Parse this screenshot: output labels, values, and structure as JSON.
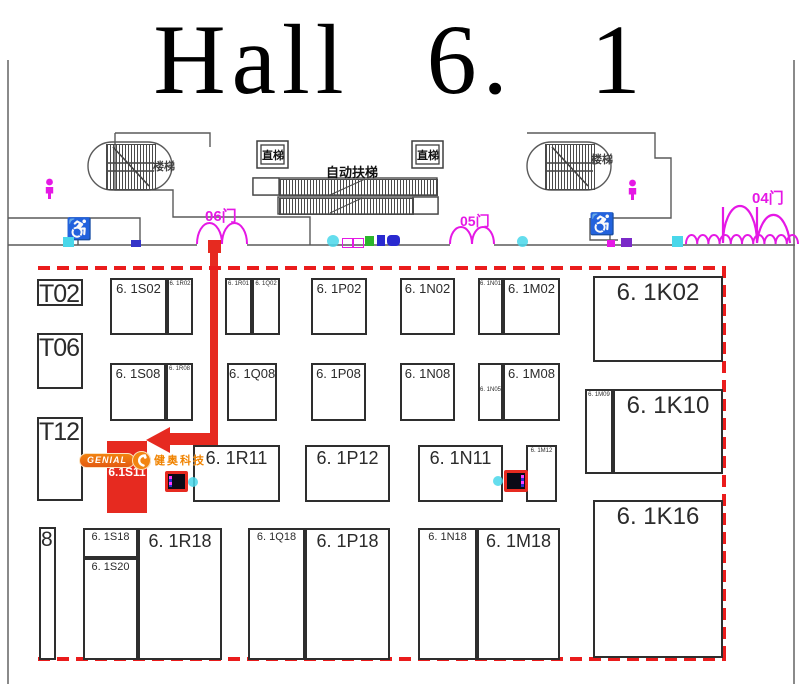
{
  "title": "Hall 6. 1",
  "facilities": {
    "stairs_left": "楼梯",
    "stairs_right": "楼梯",
    "elevator_left": "直梯",
    "elevator_right": "直梯",
    "escalator": "自动扶梯",
    "door_06": "06门",
    "door_05": "05门",
    "door_04": "04门"
  },
  "highlight": {
    "booth_label": "6.1S11",
    "logo_text": "GENIAL",
    "company_name": "健奥科技"
  },
  "colors": {
    "booth_outline": "#2e2e2e",
    "magenta": "#e518e5",
    "boundary_red": "#ea1c1c",
    "arrow_red": "#e62a20",
    "logo_orange": "#f08300",
    "cyan": "#49d7ea"
  },
  "booths": [
    {
      "label": "T02",
      "x": 37,
      "y": 279,
      "w": 46,
      "h": 27,
      "fs": 25,
      "cls": "flush"
    },
    {
      "label": "T06",
      "x": 37,
      "y": 333,
      "w": 46,
      "h": 56,
      "fs": 25,
      "cls": "flush"
    },
    {
      "label": "T12",
      "x": 37,
      "y": 417,
      "w": 46,
      "h": 84,
      "fs": 25,
      "cls": "flush"
    },
    {
      "label": "8",
      "x": 39,
      "y": 527,
      "w": 17,
      "h": 133,
      "fs": 21,
      "cls": "flush"
    },
    {
      "label": "6. 1S02",
      "x": 110,
      "y": 278,
      "w": 57,
      "h": 57,
      "fs": 13
    },
    {
      "label": "6. 1R02",
      "x": 167,
      "y": 278,
      "w": 26,
      "h": 57,
      "fs": 6
    },
    {
      "label": "6. 1R01",
      "x": 225,
      "y": 278,
      "w": 27,
      "h": 57,
      "fs": 6
    },
    {
      "label": "6. 1Q02",
      "x": 252,
      "y": 278,
      "w": 28,
      "h": 57,
      "fs": 6
    },
    {
      "label": "6. 1P02",
      "x": 311,
      "y": 278,
      "w": 56,
      "h": 57,
      "fs": 13
    },
    {
      "label": "6. 1N02",
      "x": 400,
      "y": 278,
      "w": 55,
      "h": 57,
      "fs": 13
    },
    {
      "label": "6. 1N01",
      "x": 478,
      "y": 278,
      "w": 25,
      "h": 57,
      "fs": 6
    },
    {
      "label": "6. 1M02",
      "x": 503,
      "y": 278,
      "w": 57,
      "h": 57,
      "fs": 13
    },
    {
      "label": "6. 1K02",
      "x": 593,
      "y": 276,
      "w": 130,
      "h": 86,
      "fs": 24
    },
    {
      "label": "6. 1S08",
      "x": 110,
      "y": 363,
      "w": 56,
      "h": 58,
      "fs": 13
    },
    {
      "label": "6. 1R08",
      "x": 166,
      "y": 363,
      "w": 27,
      "h": 58,
      "fs": 6
    },
    {
      "label": "6. 1Q08",
      "x": 227,
      "y": 363,
      "w": 50,
      "h": 58,
      "fs": 13
    },
    {
      "label": "6. 1P08",
      "x": 311,
      "y": 363,
      "w": 55,
      "h": 58,
      "fs": 13
    },
    {
      "label": "6. 1N08",
      "x": 400,
      "y": 363,
      "w": 55,
      "h": 58,
      "fs": 13
    },
    {
      "label": "6. 1N05",
      "x": 478,
      "y": 363,
      "w": 25,
      "h": 58,
      "fs": 6,
      "dy": 22
    },
    {
      "label": "6. 1M08",
      "x": 503,
      "y": 363,
      "w": 57,
      "h": 58,
      "fs": 13
    },
    {
      "label": "6. 1M09",
      "x": 585,
      "y": 389,
      "w": 28,
      "h": 85,
      "fs": 6
    },
    {
      "label": "6. 1K10",
      "x": 613,
      "y": 389,
      "w": 110,
      "h": 85,
      "fs": 24
    },
    {
      "label": "6. 1R11",
      "x": 193,
      "y": 445,
      "w": 87,
      "h": 57,
      "fs": 18
    },
    {
      "label": "6. 1P12",
      "x": 305,
      "y": 445,
      "w": 85,
      "h": 57,
      "fs": 18
    },
    {
      "label": "6. 1N11",
      "x": 418,
      "y": 445,
      "w": 85,
      "h": 57,
      "fs": 18
    },
    {
      "label": "6. 1M12",
      "x": 526,
      "y": 445,
      "w": 31,
      "h": 57,
      "fs": 6
    },
    {
      "label": "6. 1K16",
      "x": 593,
      "y": 500,
      "w": 130,
      "h": 158,
      "fs": 24
    },
    {
      "label": "6. 1S18",
      "x": 83,
      "y": 528,
      "w": 55,
      "h": 30,
      "fs": 11
    },
    {
      "label": "6. 1S20",
      "x": 83,
      "y": 558,
      "w": 55,
      "h": 102,
      "fs": 11
    },
    {
      "label": "6. 1R18",
      "x": 138,
      "y": 528,
      "w": 84,
      "h": 132,
      "fs": 18
    },
    {
      "label": "6. 1Q18",
      "x": 248,
      "y": 528,
      "w": 57,
      "h": 132,
      "fs": 11
    },
    {
      "label": "6. 1P18",
      "x": 305,
      "y": 528,
      "w": 85,
      "h": 132,
      "fs": 18
    },
    {
      "label": "6. 1N18",
      "x": 418,
      "y": 528,
      "w": 59,
      "h": 132,
      "fs": 11
    },
    {
      "label": "6. 1M18",
      "x": 477,
      "y": 528,
      "w": 83,
      "h": 132,
      "fs": 18
    }
  ]
}
